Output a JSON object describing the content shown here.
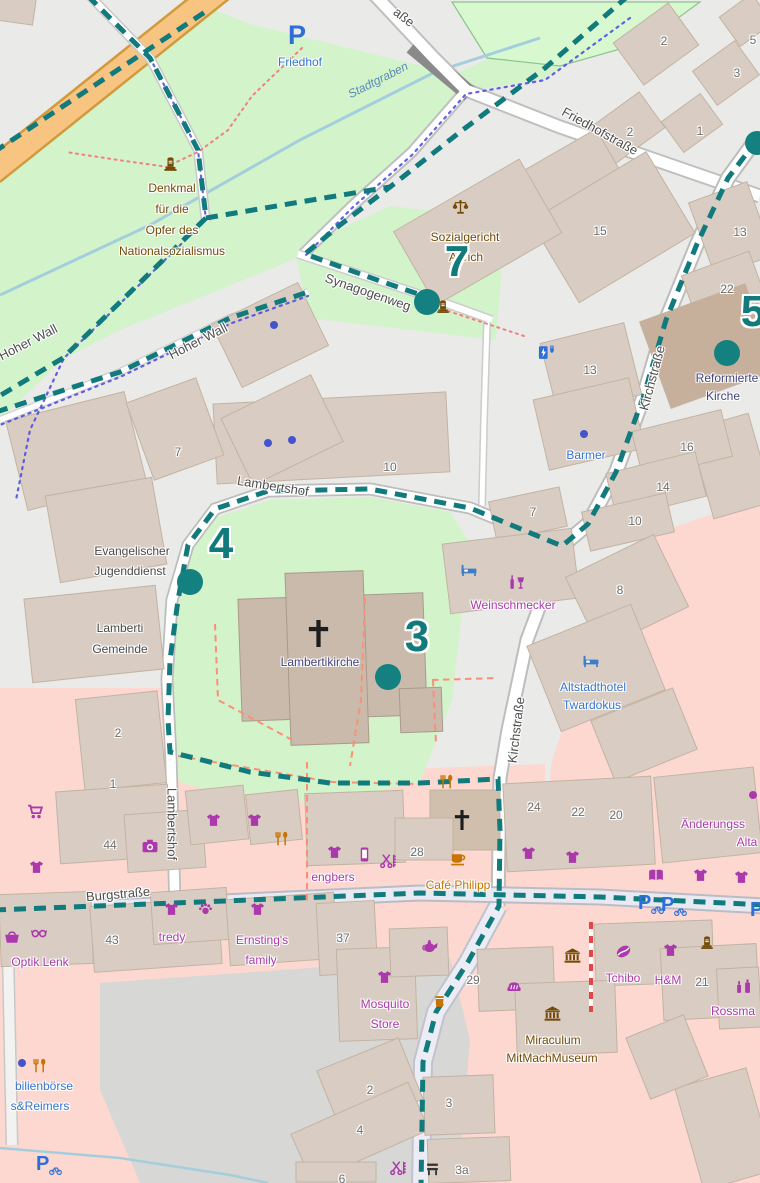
{
  "app": {
    "description": "OpenStreetMap city-centre map with dashed teal walking-tour route and numbered waypoints"
  },
  "colors": {
    "route_teal": "#107A7C",
    "waypoint_teal": "#148080",
    "park_green": "#D3F3CB",
    "retail_pink": "#FCD8D0",
    "building_tan": "#D9CDC3",
    "major_road_orange": "#F7C581",
    "water_blue": "#A4CEDC",
    "shop_purple": "#AC39AC",
    "amenity_brown": "#734A08",
    "tourism_blue": "#3575D3",
    "church_navy": "#44447E",
    "street_label_gray": "#4E4E4E"
  },
  "streets": {
    "friedhofstrasse": "Friedhofstraße",
    "strasse_top": "aße",
    "kirchstrasse": "Kirchstraße",
    "lambertshof": "Lambertshof",
    "burgstrasse": "Burgstraße",
    "hoher_wall": "Hoher Wall",
    "synagogenweg": "Synagogenweg",
    "stadtgraben": "Stadtgraben"
  },
  "pois": {
    "friedhof": "Friedhof",
    "denkmal_line1": "Denkmal",
    "denkmal_line2": "für die",
    "denkmal_line3": "Opfer des",
    "denkmal_line4": "Nationalsozialismus",
    "sozialgericht_line1": "Sozialgericht",
    "sozialgericht_line2": "Aurich",
    "reformierte_line1": "Reformierte",
    "reformierte_line2": "Kirche",
    "barmer": "Barmer",
    "evangelischer_line1": "Evangelischer",
    "evangelischer_line2": "Jugenddienst",
    "lamberti_line1": "Lamberti",
    "lamberti_line2": "Gemeinde",
    "lambertikirche": "Lambertikirche",
    "weinschmecker": "Weinschmecker",
    "altstadthotel_line1": "Altstadthotel",
    "altstadthotel_line2": "Twardokus",
    "cafe_philipp": "Café Philipp",
    "engbers": "engbers",
    "tredy": "tredy",
    "ernstings_line1": "Ernsting's",
    "ernstings_line2": "family",
    "optik_lenk": "Optik Lenk",
    "mosquito_line1": "Mosquito",
    "mosquito_line2": "Store",
    "tchibo": "Tchibo",
    "hm": "H&M",
    "rossmann": "Rossma",
    "miraculum_line1": "Miraculum",
    "miraculum_line2": "MitMachMuseum",
    "aenderungs_line1": "Änderungss",
    "aenderungs_line2": "Alta",
    "immobilien_line1": "bilienbörse",
    "immobilien_line2": "s&Reimers"
  },
  "housenumbers": [
    "2",
    "3",
    "5",
    "2",
    "1",
    "15",
    "13",
    "22",
    "13",
    "16",
    "14",
    "10",
    "7",
    "7",
    "10",
    "8",
    "2",
    "1",
    "44",
    "28",
    "24",
    "22",
    "20",
    "37",
    "43",
    "29",
    "21",
    "2",
    "3",
    "4",
    "3a",
    "6"
  ],
  "markers": {
    "m3": "3",
    "m4": "4",
    "m5": "5",
    "m7": "7"
  },
  "icons": {
    "parking_letter": "P"
  }
}
